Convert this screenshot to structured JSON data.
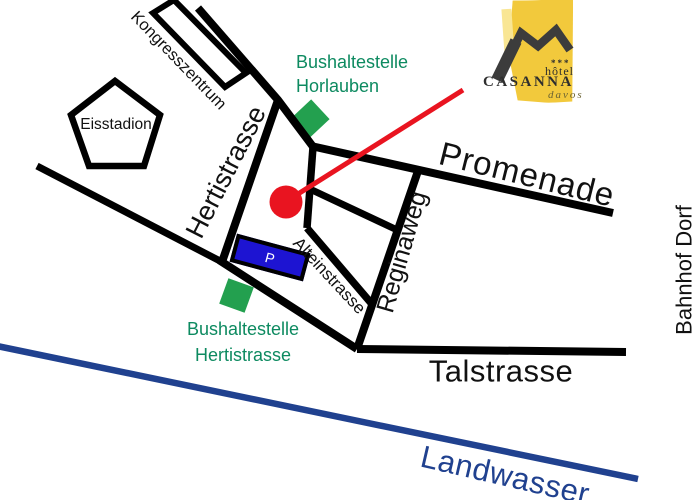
{
  "map": {
    "streets": {
      "hertistrasse": "Hertistrasse",
      "promenade": "Promenade",
      "alteinstrasse": "Alteinstrasse",
      "reginaweg": "Reginaweg",
      "talstrasse": "Talstrasse"
    },
    "river": "Landwasser",
    "places": {
      "kongresszentrum": "Kongresszentrum",
      "eisstadion": "Eisstadion",
      "bahnhof_dorf": "Bahnhof Dorf"
    },
    "bus_stops": {
      "horlauben": {
        "line1": "Bushaltestelle",
        "line2": "Horlauben"
      },
      "hertistrasse": {
        "line1": "Bushaltestelle",
        "line2": "Hertistrasse"
      }
    },
    "parking": "P"
  },
  "logo": {
    "stars": "***",
    "hotel": "hôtel",
    "name": "CASANNA",
    "city": "davos"
  },
  "colors": {
    "road": "#000000",
    "river": "#20418f",
    "bus_stop_green": "#23a04f",
    "bus_stop_text": "#0d8a60",
    "parking_blue": "#1d14d2",
    "marker_red": "#e91420",
    "logo_yellow": "#f2c93c",
    "logo_yellow_light": "#f9e694",
    "logo_mark": "#3c3c3c",
    "logo_text": "#2e2e2e",
    "logo_davos": "#6c6433",
    "label": "#111111"
  }
}
